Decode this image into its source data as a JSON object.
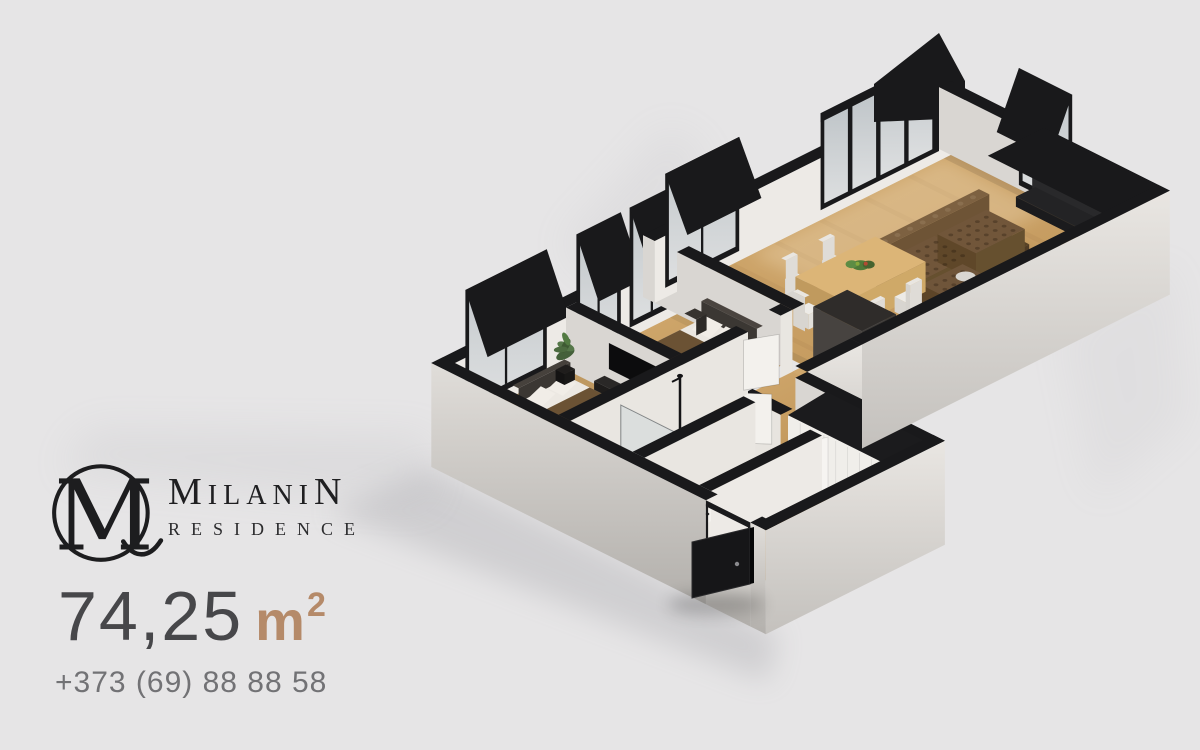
{
  "logo": {
    "monogram": "M",
    "brand_first": "M",
    "brand_mid": "ILANI",
    "brand_last": "N",
    "brand_full": "MILANIN",
    "subtitle": "RESIDENCE"
  },
  "area": {
    "value": "74,25",
    "unit": "m",
    "superscript": "2"
  },
  "contact": {
    "phone": "+373 (69) 88 88 58"
  },
  "palette": {
    "background": "#e6e5e6",
    "ink": "#19191b",
    "brand_dark": "#1d1d1f",
    "text_primary": "#47474a",
    "text_secondary": "#727275",
    "accent_tan": "#b58a69",
    "wall_top": "#19191b",
    "wall_interior_bright": "#edeae6",
    "wall_interior_shade": "#d9d6d2",
    "wall_outer_light": "#e9e6e2",
    "wall_outer_dark": "#b3b0ac",
    "floor_wood": "#c9a268",
    "floor_wood_dark": "#bd9256",
    "floor_tile": "#eae7e2",
    "sofa_brown": "#6b5234",
    "rug_dark": "#3e3b37",
    "table_wood": "#dcb577",
    "chair_white": "#edebe7",
    "glass": "#cdd3d7",
    "door_black": "#161618",
    "kitchen_dark": "#3c3936",
    "plant_green": "#4c6b40"
  },
  "floor_plan": {
    "style": "3d-isometric-apartment-render",
    "rooms": [
      "living-room",
      "kitchen-unit",
      "bedroom-primary",
      "bedroom-secondary",
      "bathroom",
      "wc",
      "hallway",
      "entry"
    ],
    "features": [
      "balcony-glass-doors",
      "panoramic-windows",
      "wardrobe-row",
      "open-entry-door",
      "sectional-sofa",
      "dining-table-with-chairs",
      "tv-media-wall",
      "beds",
      "potted-plants",
      "shower"
    ]
  }
}
